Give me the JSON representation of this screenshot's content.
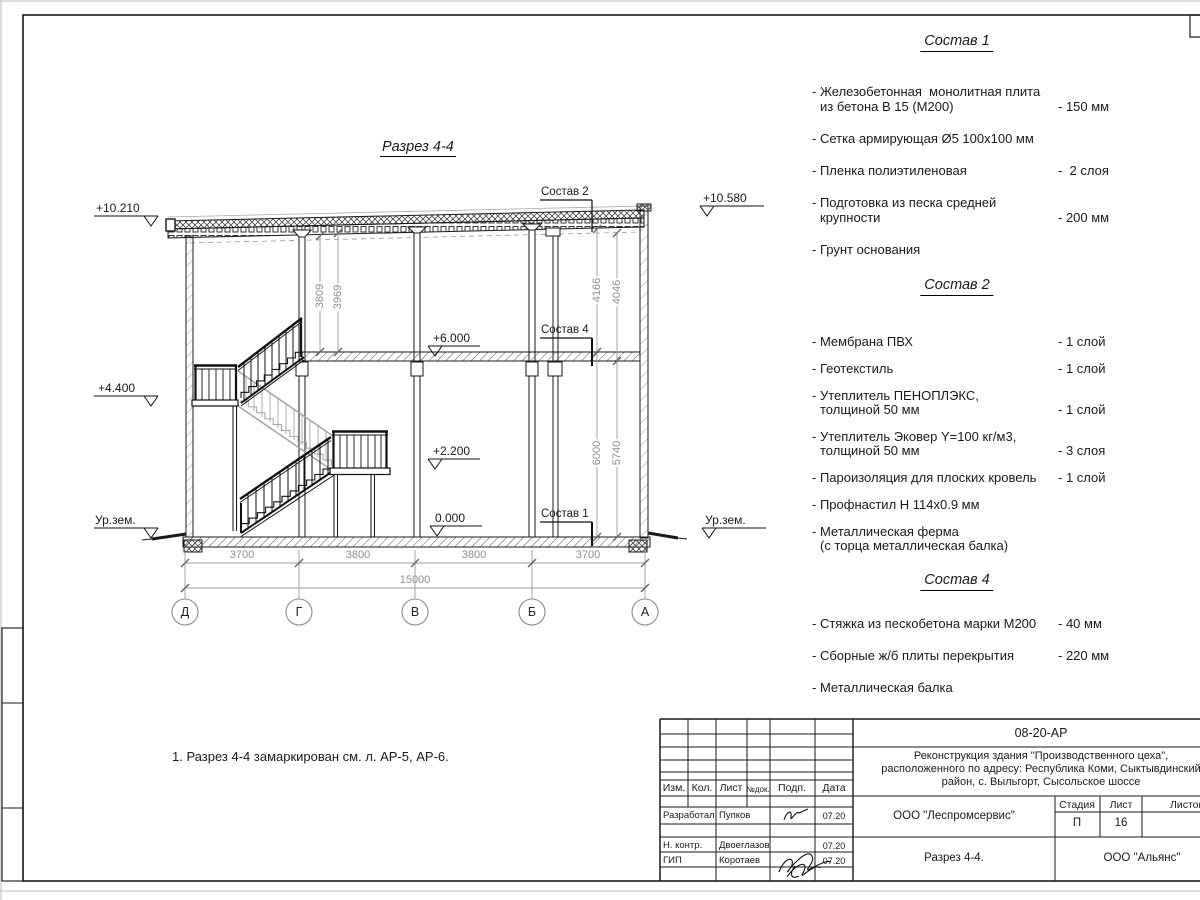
{
  "drawing": {
    "title": "Разрез 4-4",
    "note": "1. Разрез 4-4 замаркирован см. л. АР-5, АР-6.",
    "elevations": {
      "left_top": "+10.210",
      "left_mid": "+4.400",
      "ground_left": "Ур.зем.",
      "right_top": "+10.580",
      "ground_right": "Ур.зем.",
      "floor2": "+6.000",
      "landing": "+2.200",
      "zero": "0.000"
    },
    "leaders": {
      "l2": "Состав 2",
      "l4": "Состав 4",
      "l1": "Состав 1"
    },
    "vdims": {
      "a": "3809",
      "b": "3969",
      "c": "4166",
      "d": "4046",
      "e": "6000",
      "f": "5740"
    },
    "hdims": {
      "s1": "3700",
      "s2": "3800",
      "s3": "3800",
      "s4": "3700",
      "total": "15000"
    },
    "axes": {
      "a1": "Д",
      "a2": "Г",
      "a3": "В",
      "a4": "Б",
      "a5": "А"
    }
  },
  "compositions": [
    {
      "title": "Состав 1",
      "items": [
        {
          "l1": "- Железобетонная  монолитная плита",
          "l2": "из бетона В 15 (М200)",
          "v": "- 150 мм"
        },
        {
          "l1": "- Сетка армирующая Ø5 100х100 мм"
        },
        {
          "l1": "- Пленка полиэтиленовая",
          "v": "-  2 слоя"
        },
        {
          "l1": "- Подготовка из песка средней",
          "l2": "крупности",
          "v": "- 200 мм"
        },
        {
          "l1": "- Грунт основания"
        }
      ]
    },
    {
      "title": "Состав 2",
      "items": [
        {
          "l1": "- Мембрана ПВХ",
          "v": "- 1 слой"
        },
        {
          "l1": "- Геотекстиль",
          "v": "- 1 слой"
        },
        {
          "l1": "- Утеплитель ПЕНОПЛЭКС,",
          "l2": "толщиной 50 мм",
          "v": "- 1 слой"
        },
        {
          "l1": "- Утеплитель Эковер Y=100 кг/м3,",
          "l2": "толщиной 50 мм",
          "v": "- 3 слоя"
        },
        {
          "l1": "- Пароизоляция для плоских кровель",
          "v": "- 1 слой"
        },
        {
          "l1": "- Профнастил Н 114х0.9 мм"
        },
        {
          "l1": "- Металлическая ферма",
          "l2": "(с торца металлическая балка)"
        }
      ]
    },
    {
      "title": "Состав 4",
      "items": [
        {
          "l1": "- Стяжка из пескобетона марки М200",
          "v": "- 40 мм"
        },
        {
          "l1": "- Сборные ж/б плиты перекрытия",
          "v": "- 220 мм"
        },
        {
          "l1": "- Металлическая балка"
        }
      ]
    }
  ],
  "titleblock": {
    "code": "08-20-АР",
    "project1": "Реконструкция здания \"Производственного цеха\",",
    "project2": "расположенного по адресу: Республика Коми, Сыктывдинский",
    "project3": "район, с. Выльгорт, Сысольское шоссе",
    "org": "ООО \"Леспромсервис\"",
    "contractor": "ООО \"Альянс\"",
    "sheet_title": "Разрез 4-4.",
    "stage_label": "Стадия",
    "list_label": "Лист",
    "listov_label": "Листов",
    "stage": "П",
    "sheet": "16",
    "cols": {
      "izm": "Изм.",
      "kol": "Кол.",
      "list": "Лист",
      "ndok": "№док.",
      "podp": "Подп.",
      "data": "Дата"
    },
    "rows": [
      {
        "role": "Разработал",
        "name": "Пупков",
        "date": "07.20"
      },
      {
        "role": "Н. контр.",
        "name": "Двоеглазов",
        "date": "07.20"
      },
      {
        "role": "ГИП",
        "name": "Коротаев",
        "date": "07.20"
      }
    ]
  }
}
